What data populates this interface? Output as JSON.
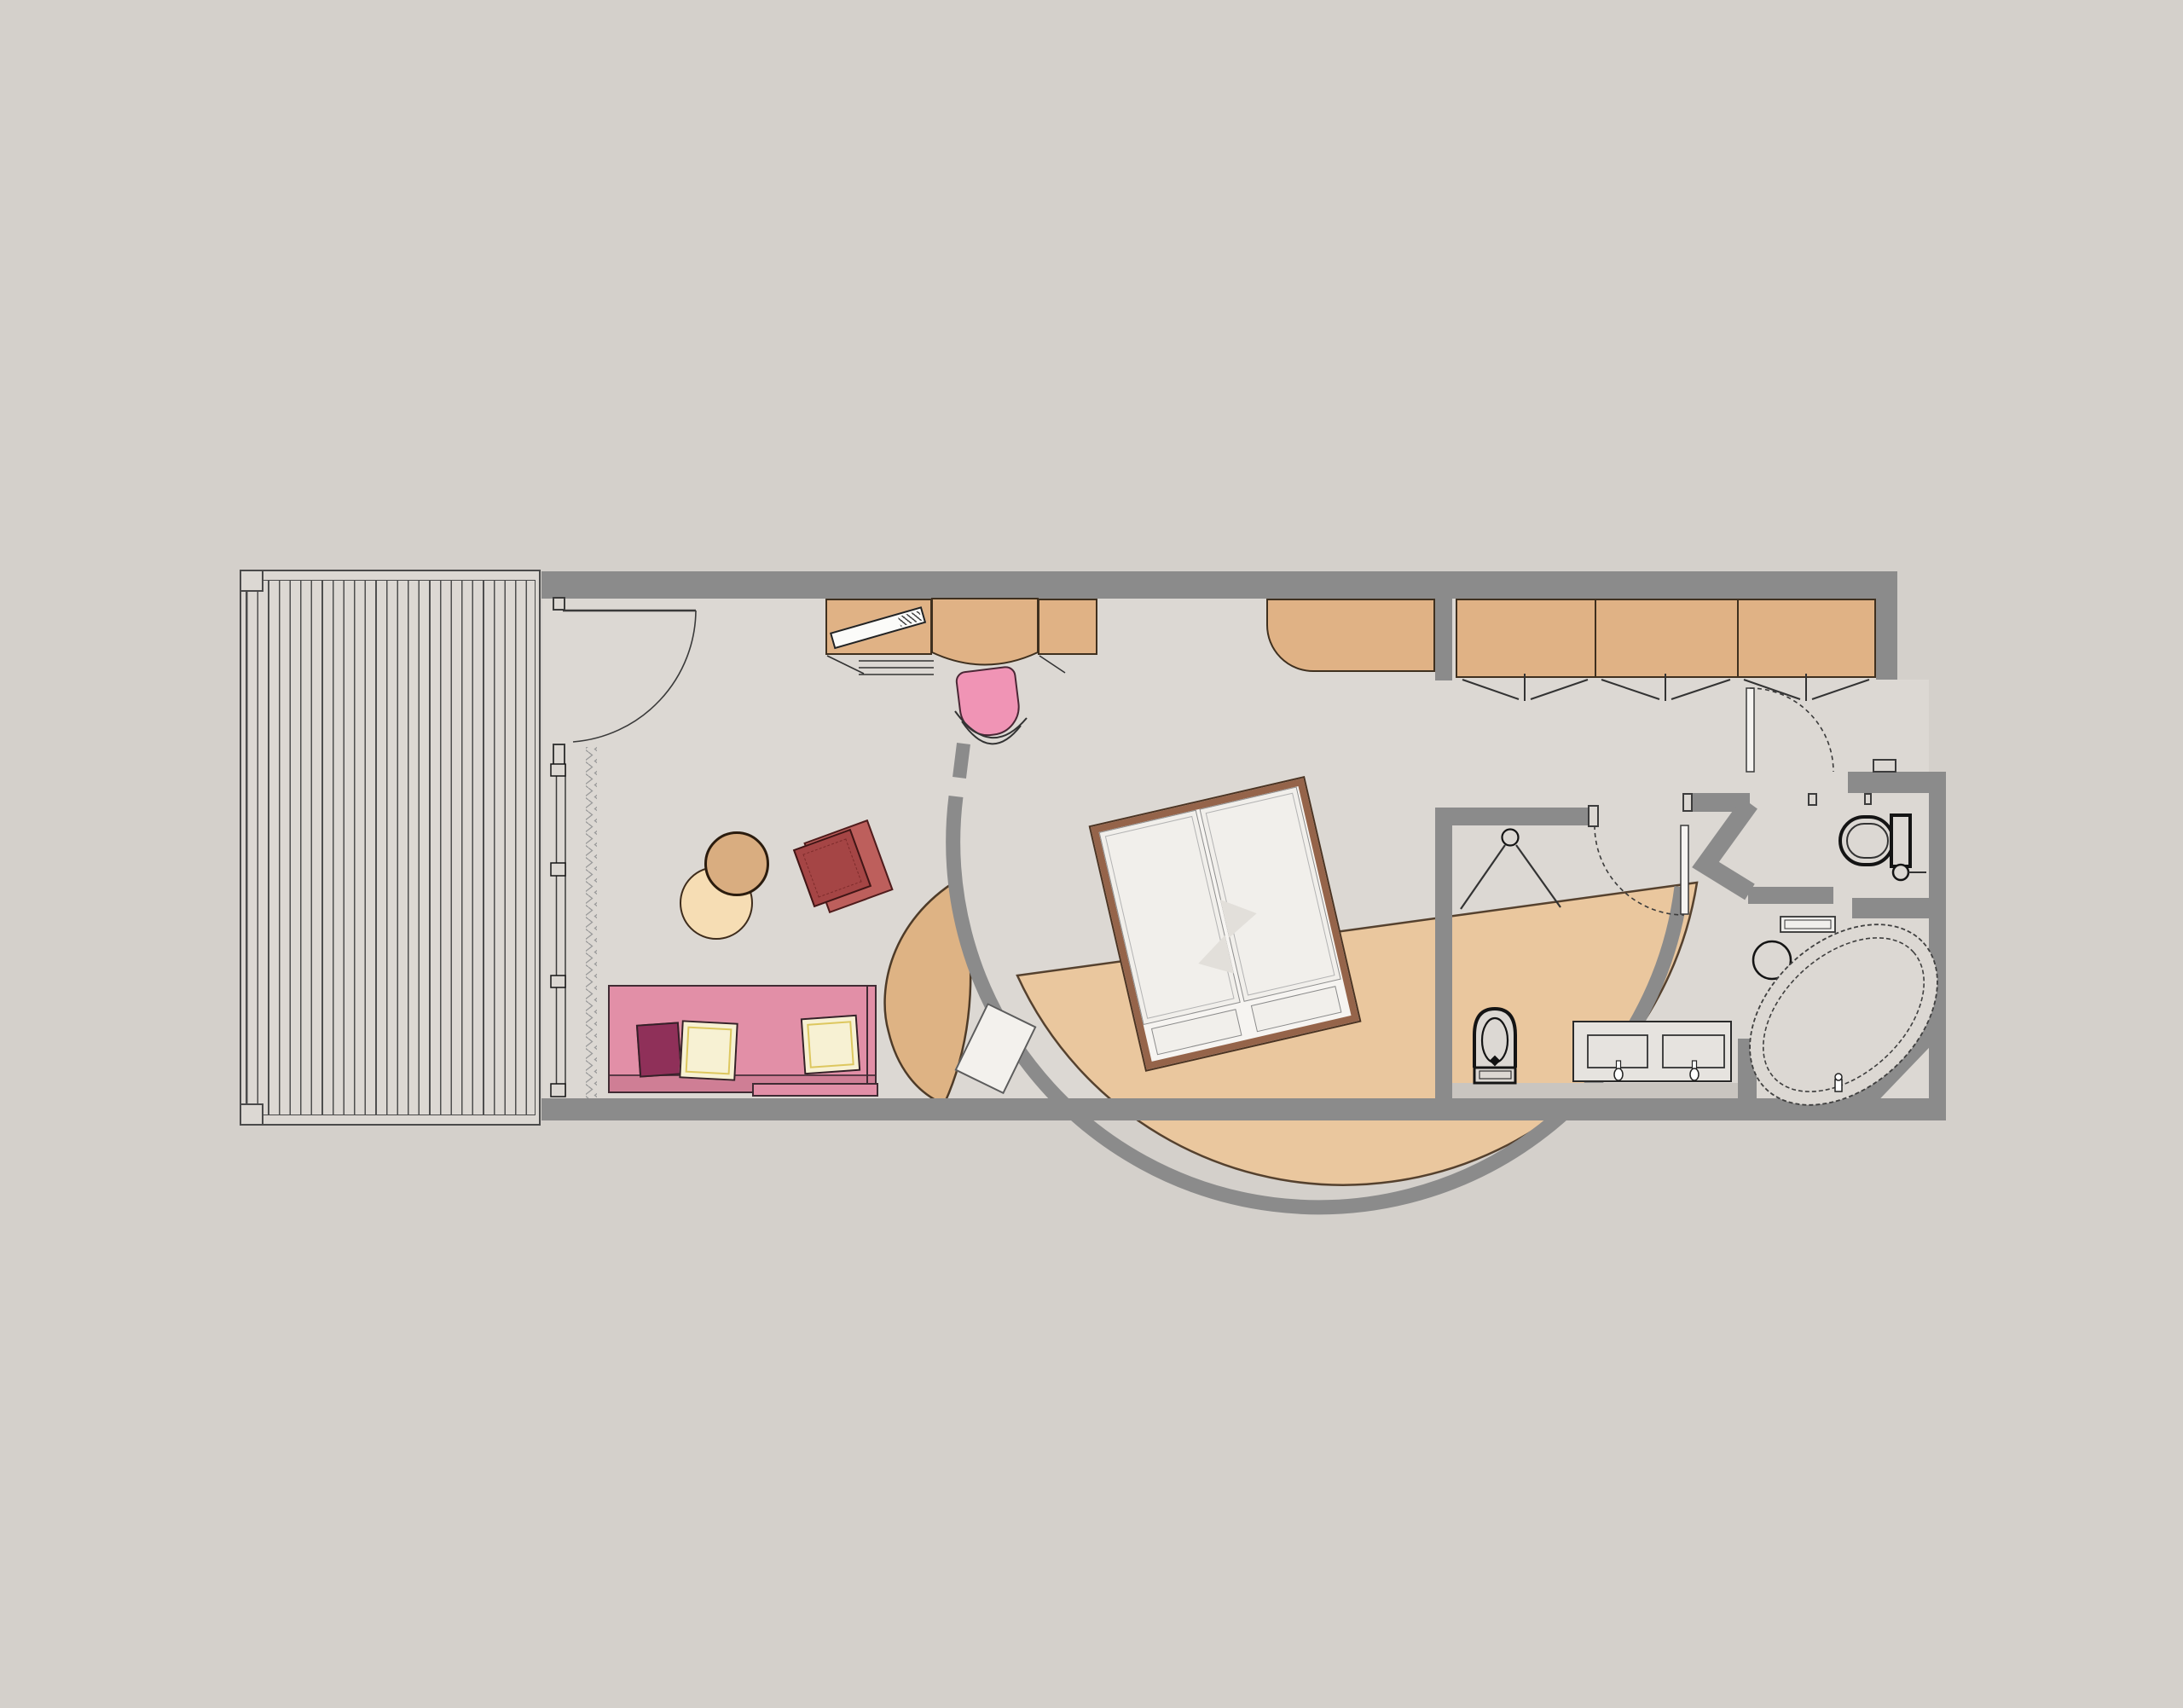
{
  "document": {
    "type": "architectural-floor-plan",
    "content": "hotel suite plan with terrace, living/sleeping room, wardrobe corridor, WC and bathroom",
    "visible_text": ""
  },
  "colors": {
    "bg": "#d4d0cb",
    "floor": "#dcd8d3",
    "wall": "#8b8b8b",
    "wall-light": "#c9c5c0",
    "tan": "#e0b285",
    "platform": "#eac79e",
    "crescent": "#deb384",
    "bed-frame": "#95644a",
    "mattress": "#f1efeb",
    "sofa": "#e28fa7",
    "sofa-dark": "#cf7e95",
    "pillow-maroon": "#8f3059",
    "pillow-cream": "#f7f1d3",
    "pillow-trim": "#ddc75f",
    "chair-red": "#a54545",
    "chair-red-light": "#bd5f5c",
    "chair-pink": "#f094b5",
    "pouf-tan": "#d9ad80",
    "pouf-cream": "#f6ddb4"
  },
  "counts": {
    "deck_planks": 27,
    "wardrobe_sections": 3,
    "wardrobe_folding_doors": 3,
    "sofa_cushions": 3,
    "poufs": 2,
    "sinks": 2,
    "doors_with_swing_arcs": 4
  },
  "elements": [
    "terrace-deck",
    "deck-posts",
    "entry-door",
    "window-wall",
    "curtain",
    "tv-sideboard",
    "tv",
    "desk",
    "desk-chair",
    "drawer-lines",
    "minibar-cabinet",
    "wardrobe",
    "wardrobe-folding-doors",
    "curved-partition-wall",
    "crescent-bench",
    "luggage-bench",
    "bed-platform",
    "double-bed",
    "footboards",
    "sofa",
    "cushions",
    "pouf-pair",
    "armchair",
    "bathroom-door",
    "wc-door",
    "shower-head",
    "bidet",
    "double-vanity",
    "faucets",
    "towel-shelf",
    "stool",
    "bathtub",
    "toilet",
    "toilet-paper-holder"
  ]
}
